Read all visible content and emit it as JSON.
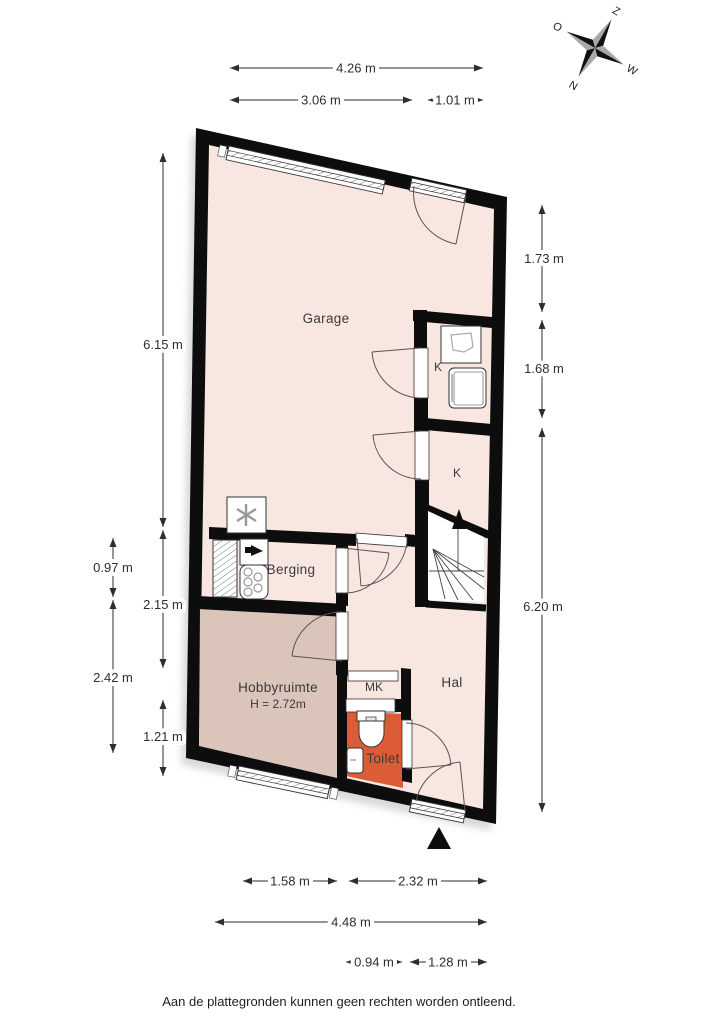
{
  "footer": "Aan de plattegronden kunnen geen rechten worden ontleend.",
  "compass": {
    "north": "N",
    "east": "O",
    "south": "Z",
    "west": "W"
  },
  "rooms": {
    "garage": "Garage",
    "k1": "K",
    "k2": "K",
    "berging": "Berging",
    "hobbyruimte": "Hobbyruimte",
    "hobbyruimte_height": "H = 2.72m",
    "mk": "MK",
    "hal": "Hal",
    "toilet": "Toilet"
  },
  "dimensions": {
    "top": [
      "4.26 m",
      "3.06 m",
      "1.01 m"
    ],
    "left": [
      "6.15 m",
      "0.97 m",
      "2.42 m",
      "2.15 m",
      "1.21 m"
    ],
    "right": [
      "1.73 m",
      "1.68 m",
      "6.20 m"
    ],
    "bottom": [
      "1.58 m",
      "2.32 m",
      "4.48 m",
      "0.94 m",
      "1.28 m"
    ]
  },
  "colors": {
    "wall": "#0d0d0d",
    "floor": "#f8e6e0",
    "hobby": "#dbc4ba",
    "toilet": "#dd5c38",
    "stairs": "#ffffff"
  }
}
